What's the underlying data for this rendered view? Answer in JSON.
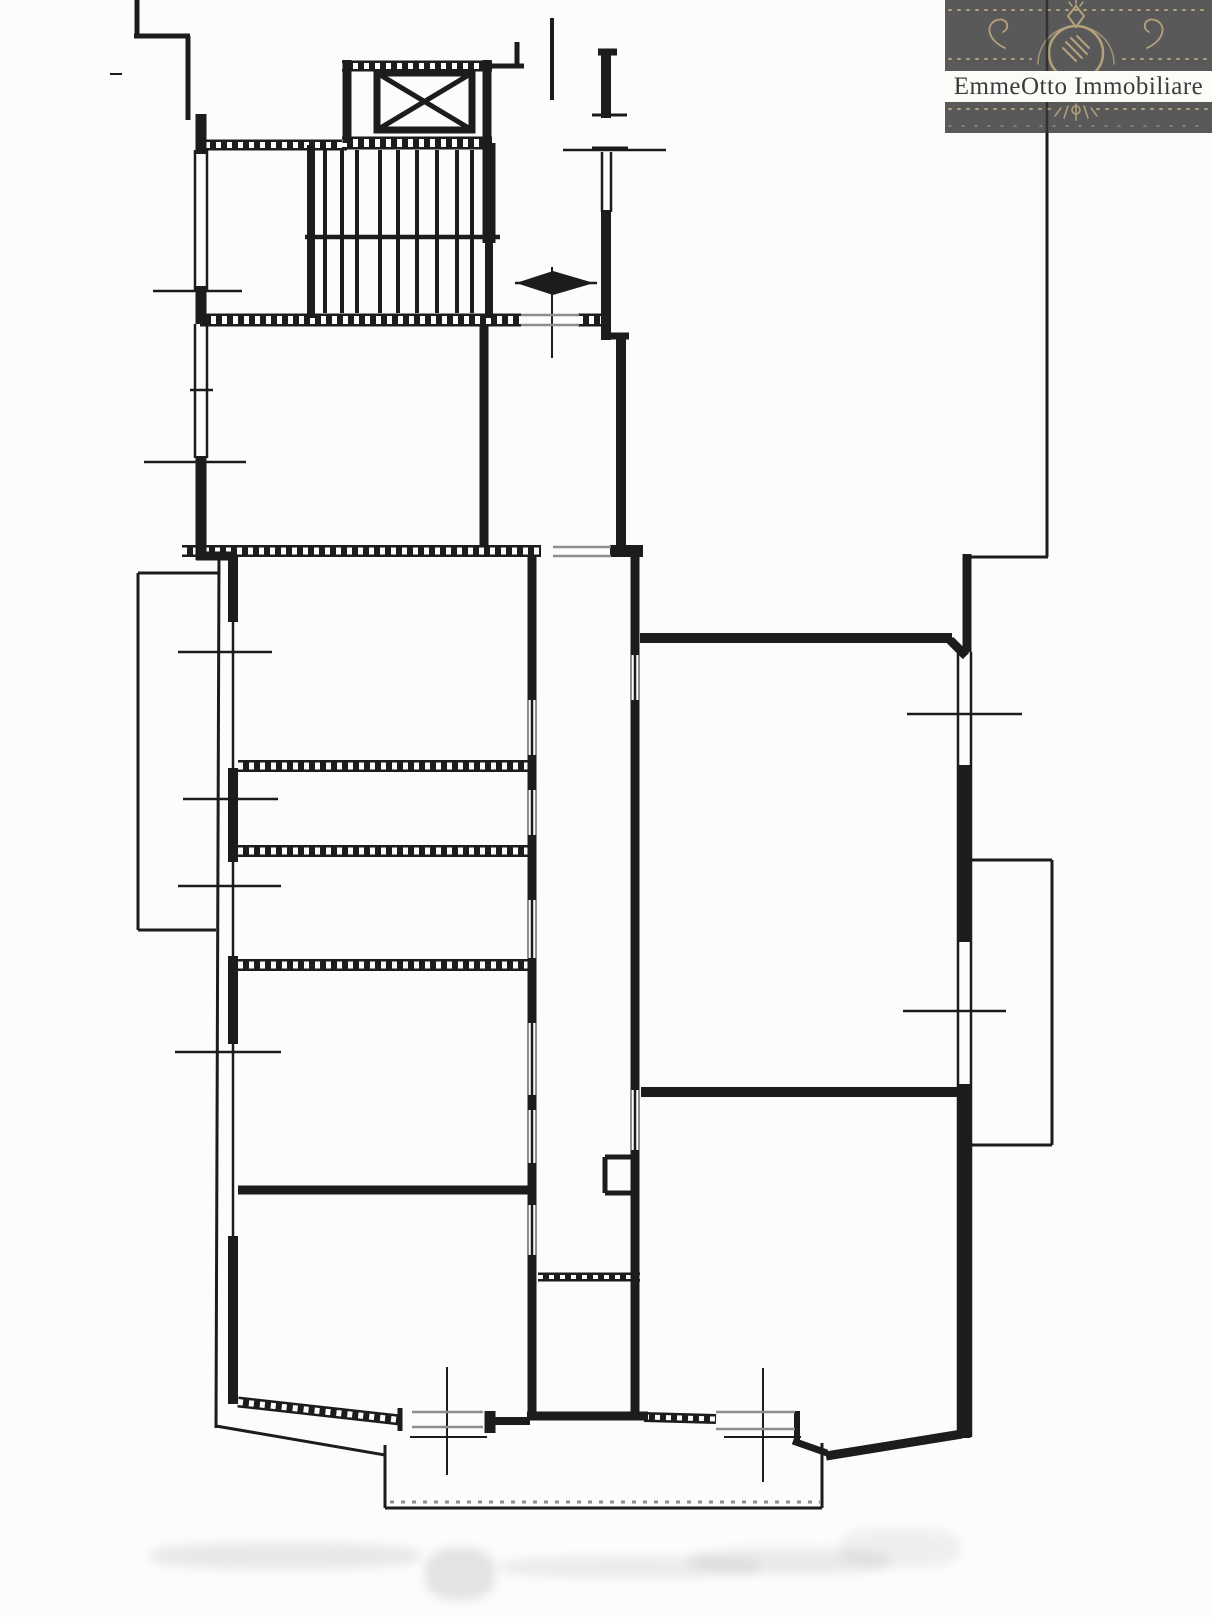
{
  "logo": {
    "text_main": "EmmeOtto Immobiliare",
    "panel_bg": "#59595a",
    "gold": "#b4a17b",
    "band_bg": "#fbfbf8",
    "text_color": "#3b3b3d"
  },
  "plan": {
    "ink": "#1c1c1c",
    "paper": "#fcfcfb",
    "gray": "#8d8d8d",
    "smudge_color": "#9a9a9a",
    "walls_thick": [
      [
        137,
        0,
        137,
        38,
        5
      ],
      [
        134,
        36,
        190,
        36,
        5
      ],
      [
        188,
        36,
        188,
        120,
        5
      ],
      [
        201,
        114,
        201,
        154,
        11
      ],
      [
        201,
        286,
        201,
        324,
        11
      ],
      [
        201,
        456,
        201,
        560,
        11
      ],
      [
        196,
        556,
        234,
        556,
        9
      ],
      [
        233,
        556,
        233,
        622,
        10
      ],
      [
        233,
        768,
        233,
        862,
        10
      ],
      [
        233,
        956,
        233,
        1044,
        10
      ],
      [
        233,
        1236,
        233,
        1404,
        10
      ],
      [
        311,
        145,
        311,
        318,
        8
      ],
      [
        489,
        143,
        489,
        318,
        8
      ],
      [
        489,
        143,
        489,
        243,
        13
      ],
      [
        347,
        60,
        347,
        143,
        9
      ],
      [
        487,
        60,
        487,
        143,
        9
      ],
      [
        517,
        42,
        517,
        68,
        5
      ],
      [
        490,
        66,
        524,
        66,
        5
      ],
      [
        552,
        18,
        552,
        100,
        4
      ],
      [
        598,
        52,
        617,
        52,
        7
      ],
      [
        606,
        50,
        606,
        118,
        10
      ],
      [
        606,
        210,
        606,
        323,
        10
      ],
      [
        606,
        318,
        606,
        340,
        10
      ],
      [
        603,
        336,
        629,
        336,
        7
      ],
      [
        621,
        336,
        621,
        546,
        10
      ],
      [
        484,
        326,
        484,
        546,
        9
      ],
      [
        610,
        551,
        643,
        551,
        12
      ],
      [
        640,
        638,
        952,
        638,
        10
      ],
      [
        950,
        640,
        966,
        656,
        9
      ],
      [
        967,
        554,
        967,
        652,
        9
      ],
      [
        964,
        765,
        964,
        942,
        13
      ],
      [
        964,
        1084,
        964,
        1438,
        13
      ],
      [
        641,
        1092,
        958,
        1092,
        10
      ],
      [
        238,
        1190,
        530,
        1190,
        9
      ],
      [
        400,
        1408,
        400,
        1431,
        5
      ],
      [
        490,
        1411,
        490,
        1433,
        11
      ],
      [
        495,
        1421,
        530,
        1421,
        8
      ],
      [
        797,
        1411,
        797,
        1441,
        6
      ],
      [
        793,
        1441,
        827,
        1453,
        7
      ],
      [
        826,
        1456,
        962,
        1434,
        9
      ],
      [
        527,
        1416,
        648,
        1416,
        9
      ],
      [
        532,
        557,
        532,
        700,
        9
      ],
      [
        532,
        755,
        532,
        790,
        9
      ],
      [
        532,
        835,
        532,
        900,
        9
      ],
      [
        532,
        958,
        532,
        1023,
        9
      ],
      [
        532,
        1095,
        532,
        1110,
        9
      ],
      [
        532,
        1163,
        532,
        1205,
        9
      ],
      [
        532,
        1255,
        532,
        1420,
        9
      ],
      [
        635,
        557,
        635,
        655,
        9
      ],
      [
        635,
        700,
        635,
        1090,
        9
      ],
      [
        635,
        1150,
        635,
        1420,
        9
      ],
      [
        605,
        1157,
        635,
        1157,
        5
      ],
      [
        605,
        1157,
        605,
        1193,
        5
      ],
      [
        605,
        1193,
        635,
        1193,
        5
      ]
    ],
    "walls_thin": [
      [
        195,
        150,
        195,
        290,
        2.5
      ],
      [
        207,
        150,
        207,
        290,
        2.5
      ],
      [
        153,
        291,
        242,
        291,
        2.5
      ],
      [
        195,
        324,
        195,
        458,
        2.5
      ],
      [
        207,
        324,
        207,
        458,
        2.5
      ],
      [
        144,
        462,
        246,
        462,
        2.5
      ],
      [
        190,
        390,
        213,
        390,
        2.5
      ],
      [
        219,
        556,
        216,
        1428,
        3
      ],
      [
        233,
        556,
        233,
        1402,
        2.5
      ],
      [
        178,
        652,
        272,
        652,
        2.5
      ],
      [
        183,
        799,
        278,
        799,
        2.5
      ],
      [
        178,
        886,
        281,
        886,
        2.5
      ],
      [
        175,
        1052,
        281,
        1052,
        2.5
      ],
      [
        138,
        573,
        219,
        573,
        3
      ],
      [
        138,
        573,
        138,
        930,
        3
      ],
      [
        138,
        930,
        216,
        930,
        3
      ],
      [
        563,
        150,
        666,
        150,
        2.5
      ],
      [
        592,
        115,
        627,
        115,
        3
      ],
      [
        592,
        148,
        628,
        148,
        3
      ],
      [
        602,
        152,
        602,
        212,
        2.5
      ],
      [
        611,
        152,
        611,
        212,
        2.5
      ],
      [
        532,
        557,
        532,
        1420,
        2.5
      ],
      [
        635,
        557,
        635,
        1420,
        2.5
      ],
      [
        1047,
        133,
        1047,
        557,
        3
      ],
      [
        967,
        557,
        1048,
        557,
        3
      ],
      [
        958,
        652,
        958,
        1437,
        2.5
      ],
      [
        971,
        652,
        971,
        1437,
        2.5
      ],
      [
        907,
        714,
        1022,
        714,
        2.5
      ],
      [
        903,
        1011,
        1006,
        1011,
        2.5
      ],
      [
        971,
        860,
        1052,
        860,
        3
      ],
      [
        1052,
        860,
        1052,
        1145,
        3
      ],
      [
        971,
        1145,
        1052,
        1145,
        3
      ],
      [
        216,
        1426,
        385,
        1455,
        3
      ],
      [
        385,
        1445,
        385,
        1508,
        3
      ],
      [
        385,
        1508,
        822,
        1508,
        3
      ],
      [
        822,
        1443,
        822,
        1508,
        3
      ],
      [
        447,
        1367,
        447,
        1475,
        2
      ],
      [
        410,
        1437,
        487,
        1437,
        2
      ],
      [
        763,
        1368,
        763,
        1482,
        2
      ],
      [
        724,
        1437,
        801,
        1437,
        2
      ],
      [
        515,
        283,
        597,
        283,
        2.5
      ],
      [
        552,
        267,
        552,
        358,
        2
      ],
      [
        110,
        74,
        122,
        74,
        2
      ],
      [
        305,
        237,
        500,
        237,
        4.5
      ]
    ],
    "walls_hatched": [
      [
        205,
        145,
        347,
        145,
        11
      ],
      [
        342,
        66,
        492,
        66,
        11
      ],
      [
        342,
        143,
        492,
        143,
        13
      ],
      [
        200,
        320,
        521,
        320,
        13
      ],
      [
        578,
        320,
        604,
        320,
        13
      ],
      [
        182,
        551,
        541,
        551,
        12
      ],
      [
        238,
        766,
        533,
        766,
        12
      ],
      [
        238,
        851,
        533,
        851,
        12
      ],
      [
        238,
        965,
        533,
        965,
        12
      ],
      [
        538,
        1277,
        640,
        1277,
        9
      ],
      [
        238,
        1402,
        400,
        1420,
        11
      ],
      [
        644,
        1417,
        716,
        1419,
        10
      ]
    ],
    "gray_lines": [
      [
        521,
        315,
        579,
        315,
        2.5
      ],
      [
        521,
        325,
        579,
        325,
        2.5
      ],
      [
        553,
        547,
        611,
        547,
        2.5
      ],
      [
        553,
        556,
        611,
        556,
        2.5
      ],
      [
        528,
        700,
        528,
        755,
        2
      ],
      [
        536,
        700,
        536,
        755,
        2
      ],
      [
        528,
        790,
        528,
        835,
        2
      ],
      [
        536,
        790,
        536,
        835,
        2
      ],
      [
        528,
        900,
        528,
        958,
        2
      ],
      [
        536,
        900,
        536,
        958,
        2
      ],
      [
        528,
        1023,
        528,
        1095,
        2
      ],
      [
        536,
        1023,
        536,
        1095,
        2
      ],
      [
        528,
        1110,
        528,
        1163,
        2
      ],
      [
        536,
        1110,
        536,
        1163,
        2
      ],
      [
        528,
        1205,
        528,
        1255,
        2
      ],
      [
        536,
        1205,
        536,
        1255,
        2
      ],
      [
        631,
        655,
        631,
        700,
        2
      ],
      [
        639,
        655,
        639,
        700,
        2
      ],
      [
        631,
        1090,
        631,
        1150,
        2
      ],
      [
        639,
        1090,
        639,
        1150,
        2
      ],
      [
        412,
        1412,
        483,
        1412,
        2.5
      ],
      [
        412,
        1427,
        483,
        1427,
        2.5
      ],
      [
        716,
        1412,
        795,
        1412,
        2.5
      ],
      [
        716,
        1429,
        795,
        1429,
        2.5
      ]
    ],
    "gray_dashed": [
      [
        390,
        1502,
        820,
        1502,
        3
      ]
    ],
    "stairs": {
      "xs": [
        325,
        342,
        357,
        380,
        398,
        417,
        437,
        457,
        472
      ],
      "y1": 150,
      "y2": 313,
      "w": 4
    },
    "elevator": {
      "cab": [
        377,
        73,
        472,
        130
      ],
      "cab_stroke": 7,
      "diag_stroke": 5
    },
    "arrow_polys": [
      [
        [
          516,
          283
        ],
        [
          553,
          271
        ],
        [
          553,
          295
        ]
      ],
      [
        [
          594,
          283
        ],
        [
          553,
          271
        ],
        [
          553,
          295
        ]
      ]
    ],
    "smudges": [
      {
        "x": 150,
        "y": 1543,
        "w": 270,
        "h": 26,
        "o": 0.2
      },
      {
        "x": 425,
        "y": 1548,
        "w": 70,
        "h": 52,
        "o": 0.25
      },
      {
        "x": 500,
        "y": 1556,
        "w": 260,
        "h": 22,
        "o": 0.16
      },
      {
        "x": 690,
        "y": 1548,
        "w": 200,
        "h": 26,
        "o": 0.18
      },
      {
        "x": 840,
        "y": 1528,
        "w": 120,
        "h": 40,
        "o": 0.13
      }
    ]
  }
}
